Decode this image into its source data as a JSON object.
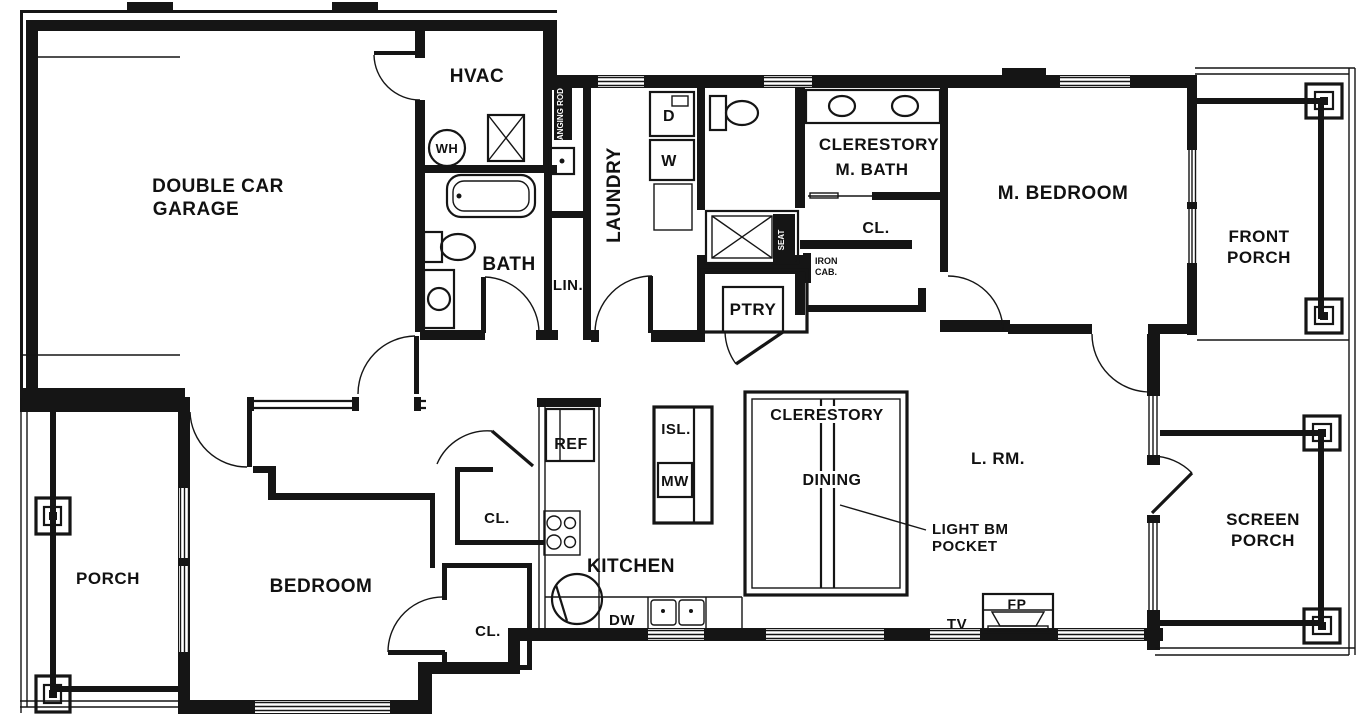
{
  "drawing": {
    "type": "residential floor plan",
    "colors": {
      "line": "#151515",
      "background": "#ffffff"
    },
    "rooms": {
      "garage": {
        "l1": "DOUBLE CAR",
        "l2": "GARAGE"
      },
      "hvac": {
        "label": "HVAC"
      },
      "bath": {
        "label": "BATH"
      },
      "linen": {
        "label": "LIN."
      },
      "laundry": {
        "label": "LAUNDRY"
      },
      "pantry": {
        "label": "PTRY"
      },
      "master_bath": {
        "l1": "CLERESTORY",
        "l2": "M. BATH"
      },
      "master_closet": {
        "label": "CL."
      },
      "master_bedroom": {
        "label": "M. BEDROOM"
      },
      "front_porch": {
        "l1": "FRONT",
        "l2": "PORCH"
      },
      "dining": {
        "l1": "CLERESTORY",
        "l2": "DINING"
      },
      "living": {
        "label": "L. RM."
      },
      "kitchen": {
        "label": "KITCHEN"
      },
      "bedroom": {
        "label": "BEDROOM"
      },
      "porch": {
        "label": "PORCH"
      },
      "screen_porch": {
        "l1": "SCREEN",
        "l2": "PORCH"
      },
      "closet_upper": {
        "label": "CL."
      },
      "closet_lower": {
        "label": "CL."
      }
    },
    "fixtures": {
      "water_heater": "WH",
      "dryer": "D",
      "washer": "W",
      "refrigerator": "REF",
      "island": "ISL.",
      "microwave": "MW",
      "dishwasher": "DW",
      "fireplace": "FP",
      "tv": "TV"
    },
    "annotations": {
      "hanging_rod": "HANGING ROD",
      "shower_seat": "SEAT",
      "iron_cabinet_l1": "IRON",
      "iron_cabinet_l2": "CAB.",
      "light_beam_l1": "LIGHT BM",
      "light_beam_l2": "POCKET"
    }
  }
}
